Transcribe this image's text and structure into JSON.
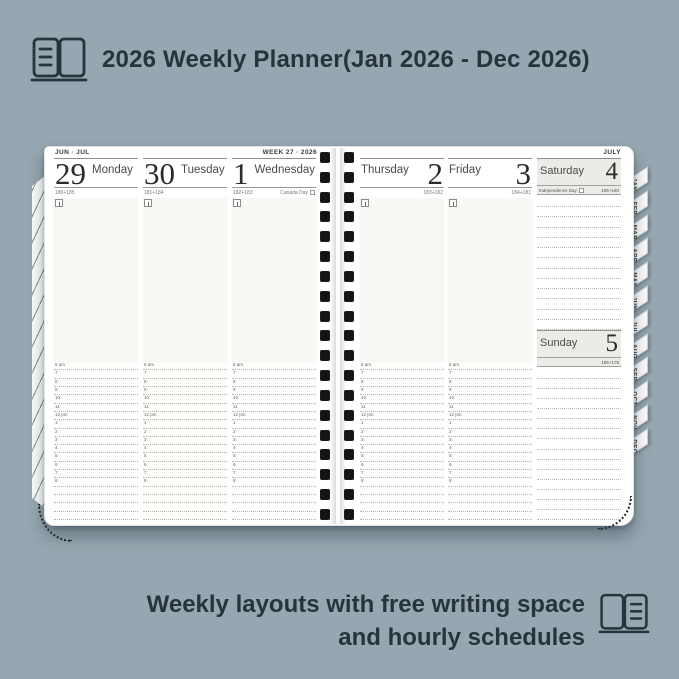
{
  "header": {
    "title": "2026 Weekly Planner(Jan 2026 - Dec 2026)"
  },
  "footer": {
    "line1": "Weekly layouts with free writing space",
    "line2": "and hourly schedules"
  },
  "planner": {
    "left_page": {
      "month_label": "JUN · JUL",
      "week_label": "WEEK 27 · 2026",
      "days": [
        {
          "number": "29",
          "name": "Monday",
          "day_count": "180+185",
          "holiday": ""
        },
        {
          "number": "30",
          "name": "Tuesday",
          "day_count": "181+184",
          "holiday": ""
        },
        {
          "number": "1",
          "name": "Wednesday",
          "day_count": "182+183",
          "holiday": "Canada Day"
        }
      ]
    },
    "right_page": {
      "month_label": "JULY",
      "days": [
        {
          "number": "2",
          "name": "Thursday",
          "day_count": "183+182",
          "holiday": ""
        },
        {
          "number": "3",
          "name": "Friday",
          "day_count": "184+181",
          "holiday": ""
        }
      ],
      "weekend": [
        {
          "number": "4",
          "name": "Saturday",
          "day_count": "185+180",
          "holiday": "Independence Day"
        },
        {
          "number": "5",
          "name": "Sunday",
          "day_count": "186+179",
          "holiday": ""
        }
      ]
    },
    "hours": [
      "6 am",
      "7",
      "8",
      "9",
      "10",
      "11",
      "12 pm",
      "1",
      "2",
      "3",
      "4",
      "5",
      "6",
      "7",
      "8"
    ],
    "month_tabs": [
      "JAN",
      "FEB",
      "MAR",
      "APR",
      "MAY",
      "JUN",
      "JUL",
      "AUG",
      "SEP",
      "OCT",
      "NOV",
      "DEC"
    ],
    "binding_holes_per_side": 19
  },
  "colors": {
    "background": "#96a7b1",
    "ink": "#27343e",
    "page": "#ffffff",
    "weekend_header": "#ebebe8"
  }
}
